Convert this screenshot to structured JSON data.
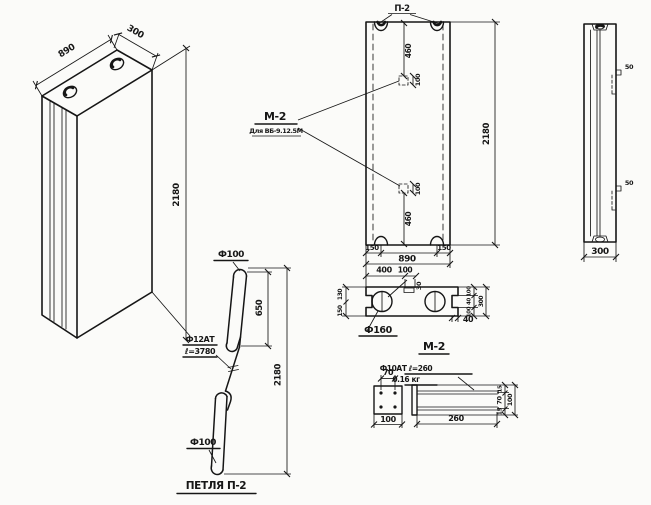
{
  "iso": {
    "dim_width": "890",
    "dim_depth": "300",
    "dim_height": "2180"
  },
  "front": {
    "loop_label": "П-2",
    "dim_top_to_plate": "460",
    "plate_dim_top": "100",
    "m2_label": "М-2",
    "m2_note": "Для ВБ-9.12.5М",
    "plate_dim_bottom": "100",
    "dim_plate_to_bottom": "460",
    "dim_height": "2180",
    "dim_left_loop": "150",
    "dim_width": "890",
    "dim_right_loop": "150",
    "dim_hole_400": "400",
    "dim_hole_100": "100",
    "dim_gap_30": "30"
  },
  "section": {
    "hole_label": "Ф160",
    "dim_40": "40",
    "left_dims": [
      "130",
      "150"
    ],
    "right_dims": [
      "100",
      "40",
      "100"
    ],
    "right_total": "300"
  },
  "side": {
    "bracket_top_dim": "50",
    "bracket_bottom_dim": "50",
    "dim_depth": "300"
  },
  "loop_detail": {
    "title": "ПЕТЛЯ П-2",
    "top_dia": "Ф100",
    "upper_len": "650",
    "bar_label": "Ф12АТ",
    "bar_len": "ℓ=3780",
    "total_len": "2180",
    "bottom_dia": "Ф100"
  },
  "m2_detail": {
    "title": "М-2",
    "plate_top_dim": "70",
    "plate_bottom_dim": "100",
    "rod_label": "Ф10АТ ℓ=260",
    "weight": "0.16 кг",
    "rod_len": "260",
    "v_dims": [
      "15",
      "70",
      "15"
    ],
    "v_total": "100"
  }
}
